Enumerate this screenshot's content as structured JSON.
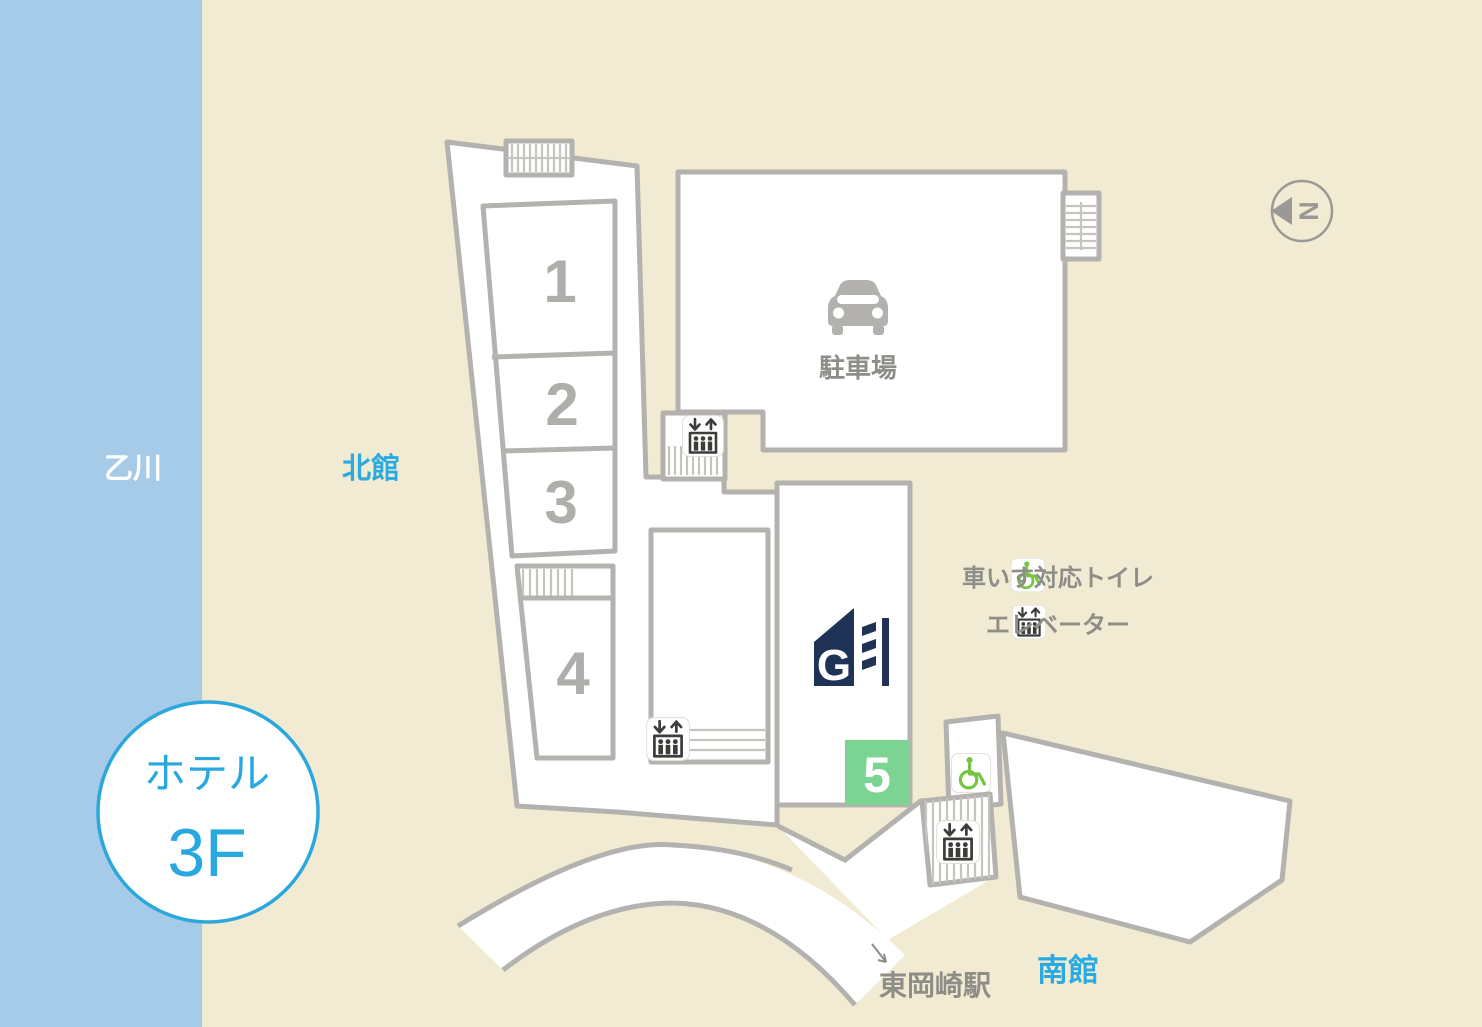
{
  "labels": {
    "river": "乙川",
    "north_wing": "北館",
    "south_wing": "南館",
    "station": "東岡崎駅",
    "parking": "駐車場",
    "compass": "N",
    "hotel": "ホテル",
    "floor": "3F"
  },
  "rooms": {
    "room1": "1",
    "room2": "2",
    "room3": "3",
    "room4": "4",
    "room5": "5"
  },
  "legend": {
    "items": [
      {
        "icon": "wheelchair-icon",
        "label": "車いす対応トイレ"
      },
      {
        "icon": "elevator-icon",
        "label": "エレベーター"
      }
    ]
  },
  "colors": {
    "river": "#a5cbe9",
    "land": "#f0ebd2",
    "outline": "#b4b2ae",
    "gray_text": "#8f8d88",
    "accent_blue": "#2ba9e1",
    "wheelchair_green": "#76c442",
    "room5_green": "#7cd492",
    "logo_navy": "#1f3356"
  }
}
